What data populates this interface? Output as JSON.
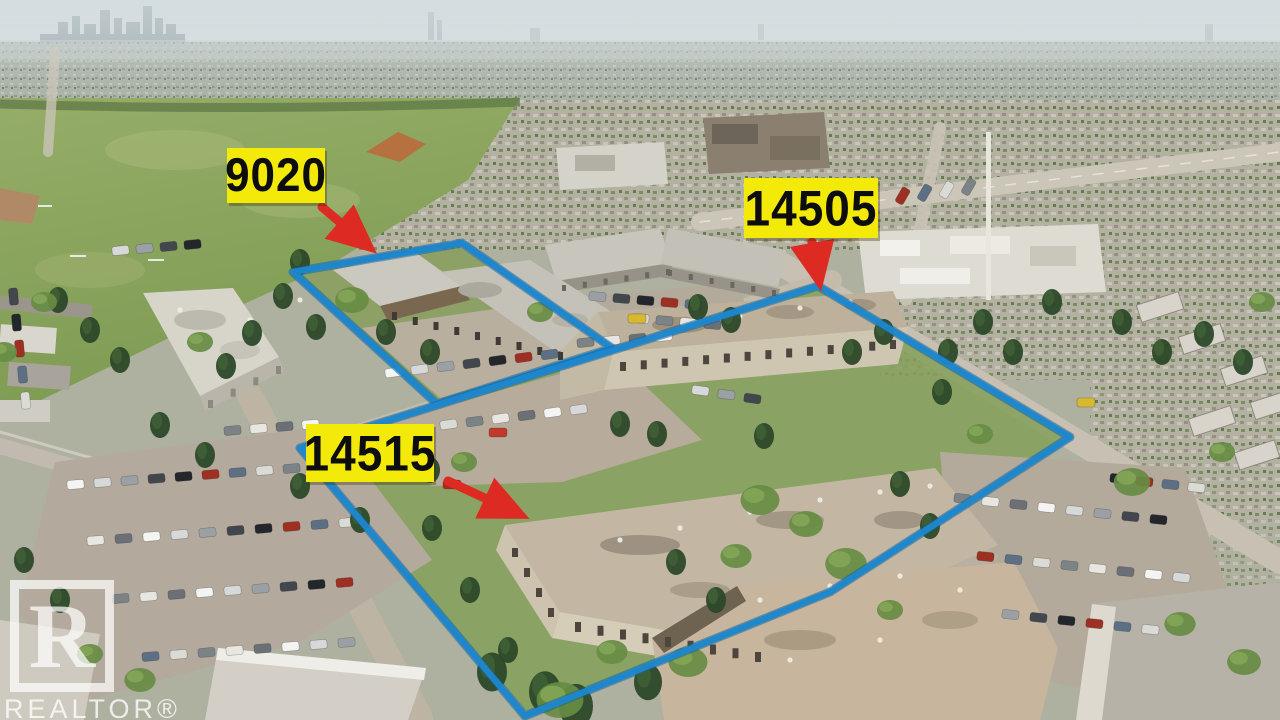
{
  "image": {
    "type": "real-estate-aerial-photo",
    "description": "Aerial drone photo of apartment complex with outlined property boundaries"
  },
  "annotations": {
    "boundary_color": "#1d87cd",
    "boundary_shadow_color": "#0f5f98",
    "arrow_color": "#dd2a22",
    "label_background": "#f3ea09",
    "label_text_color": "#0d0d0d",
    "parcels": [
      {
        "name": "parcel-9020",
        "points": "293,272 462,243 612,348 437,404"
      },
      {
        "name": "parcel-14505-14515",
        "points": "300,448 818,286 1070,437 830,592 525,716"
      }
    ],
    "labels": [
      {
        "text": "9020",
        "left": 227,
        "top": 148,
        "width": 98,
        "height": 55,
        "font": 44,
        "arrow": {
          "x1": 322,
          "y1": 207,
          "x2": 368,
          "y2": 246
        }
      },
      {
        "text": "14505",
        "left": 744,
        "top": 178,
        "width": 134,
        "height": 60,
        "font": 46,
        "arrow": {
          "x1": 812,
          "y1": 242,
          "x2": 819,
          "y2": 280
        }
      },
      {
        "text": "14515",
        "left": 306,
        "top": 424,
        "width": 128,
        "height": 58,
        "font": 46,
        "arrow": {
          "x1": 448,
          "y1": 481,
          "x2": 519,
          "y2": 514
        }
      }
    ]
  },
  "watermark": {
    "logo_letter": "R",
    "text": "REALTOR®"
  }
}
